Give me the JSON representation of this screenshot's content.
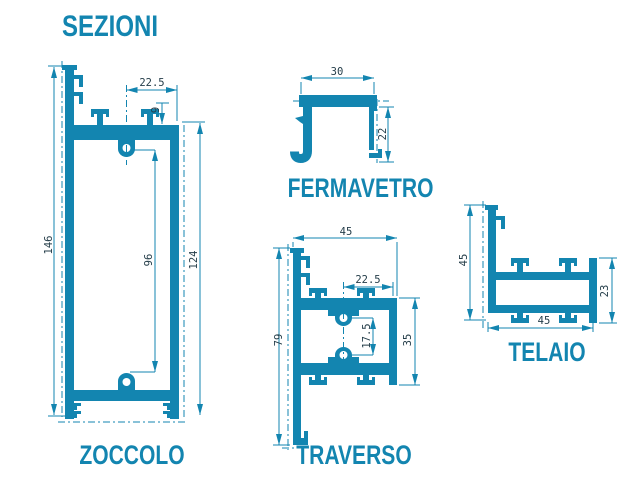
{
  "title": "SEZIONI",
  "colors": {
    "accent": "#1385b0",
    "dim_text": "#243d49",
    "background": "#ffffff"
  },
  "profiles": {
    "zoccolo": {
      "label": "ZOCCOLO",
      "dims": {
        "top_width": "22.5",
        "top_inset": "9",
        "total_height": "146",
        "inner_height": "96",
        "right_height": "124"
      }
    },
    "fermavetro": {
      "label": "FERMAVETRO",
      "dims": {
        "width": "30",
        "height": "22"
      }
    },
    "traverso": {
      "label": "TRAVERSO",
      "dims": {
        "width": "45",
        "half_width": "22.5",
        "boss_gap": "17.5",
        "total_height": "79",
        "right_height": "35"
      }
    },
    "telaio": {
      "label": "TELAIO",
      "dims": {
        "left_height": "45",
        "bottom_width": "45",
        "right_height": "23"
      }
    }
  }
}
